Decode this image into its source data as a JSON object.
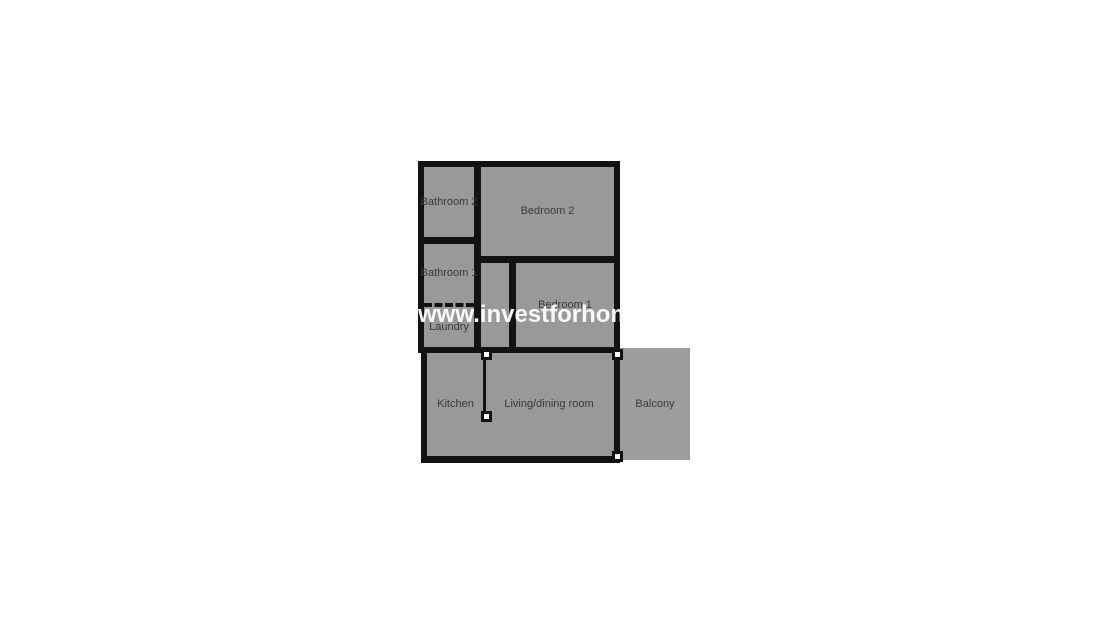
{
  "watermark": "www.investforhom",
  "rooms": {
    "bathroom2": "Bathroom 2",
    "bedroom2": "Bedroom 2",
    "bathroom1": "Bathroom 1",
    "laundry": "Laundry",
    "bedroom1": "Bedroom 1",
    "kitchen": "Kitchen",
    "living": "Living/dining room",
    "balcony": "Balcony"
  },
  "colors": {
    "background": "#ffffff",
    "wall": "#121212",
    "room_fill": "#999999",
    "balcony_fill": "#9d9d9d",
    "label_text": "#3a3a3a",
    "watermark_text": "#ffffff",
    "marker_fill": "#ffffff"
  }
}
